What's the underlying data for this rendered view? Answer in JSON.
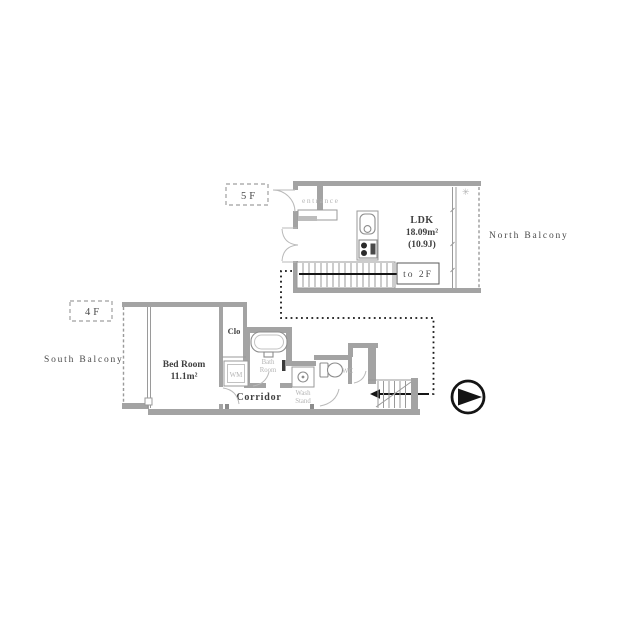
{
  "upper": {
    "tag": "5F",
    "entrance": "entrance",
    "ldk": "LDK",
    "ldk_area": "18.09m²",
    "ldk_tatami": "(10.9J)",
    "to_2f": "to 2F",
    "balcony": "North Balcony",
    "vent_mark": "✳"
  },
  "lower": {
    "tag": "4F",
    "bedroom": "Bed Room",
    "bedroom_area": "11.1m²",
    "closet": "Clo",
    "washing_machine": "WM",
    "bath_line1": "Bath",
    "bath_line2": "Room",
    "wash_line1": "Wash",
    "wash_line2": "Stand",
    "wc": "WC",
    "corridor": "Corridor",
    "balcony": "South Balcony"
  },
  "colors": {
    "wall": "#a3a3a3",
    "wall_light": "#bdbdbd",
    "outline": "#9a9a9a",
    "text_dark": "#3f3f3f",
    "text_light": "#b5b5b5",
    "route": "#161616"
  }
}
